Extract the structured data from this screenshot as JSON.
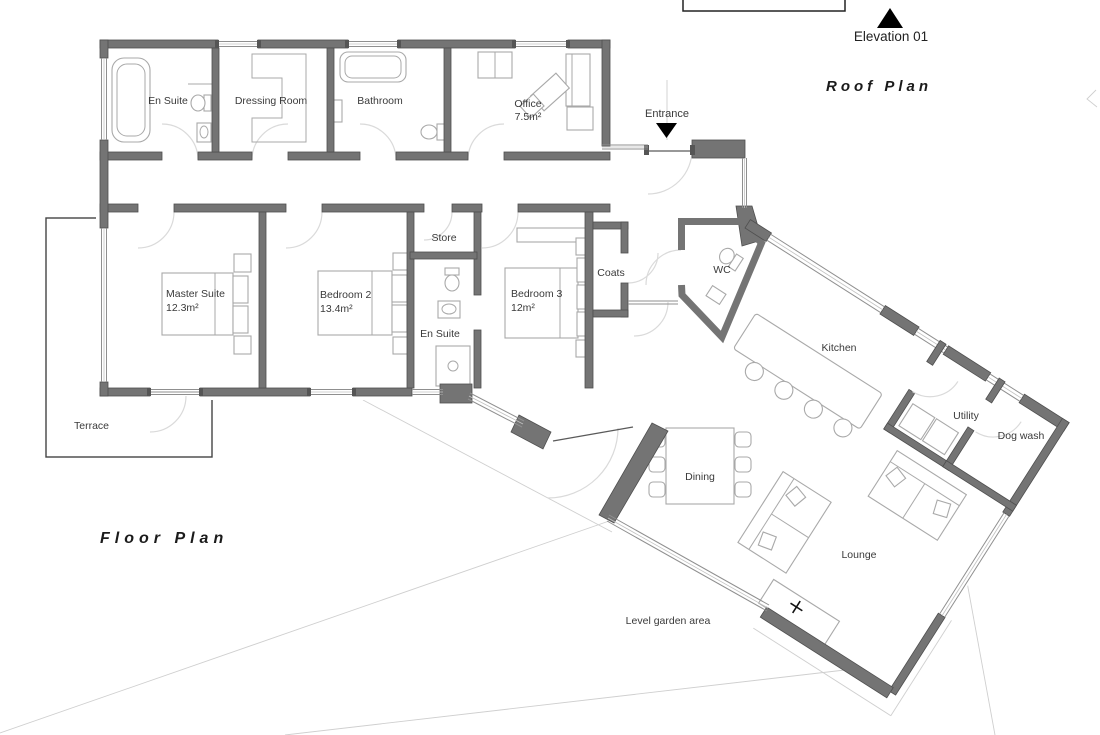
{
  "titles": {
    "floor_plan": "Floor Plan",
    "roof_plan": "Roof Plan",
    "elevation": "Elevation 01"
  },
  "annotations": {
    "entrance": "Entrance",
    "terrace": "Terrace",
    "garden": "Level garden area"
  },
  "rooms": {
    "ensuite_top": {
      "name": "En Suite"
    },
    "dressing": {
      "name": "Dressing Room"
    },
    "bathroom": {
      "name": "Bathroom"
    },
    "office": {
      "name": "Office",
      "area": "7.5m²"
    },
    "master": {
      "name": "Master Suite",
      "area": "12.3m²"
    },
    "bedroom2": {
      "name": "Bedroom 2",
      "area": "13.4m²"
    },
    "store": {
      "name": "Store"
    },
    "ensuite2": {
      "name": "En Suite"
    },
    "bedroom3": {
      "name": "Bedroom 3",
      "area": "12m²"
    },
    "coats": {
      "name": "Coats"
    },
    "wc": {
      "name": "WC"
    },
    "kitchen": {
      "name": "Kitchen"
    },
    "utility": {
      "name": "Utility"
    },
    "dogwash": {
      "name": "Dog wash"
    },
    "dining": {
      "name": "Dining"
    },
    "lounge": {
      "name": "Lounge"
    }
  },
  "colors": {
    "wall": "#747474",
    "wall_outline": "#4f4f4f",
    "text": "#3a3a3a",
    "marker": "#000000",
    "background": "#ffffff"
  }
}
